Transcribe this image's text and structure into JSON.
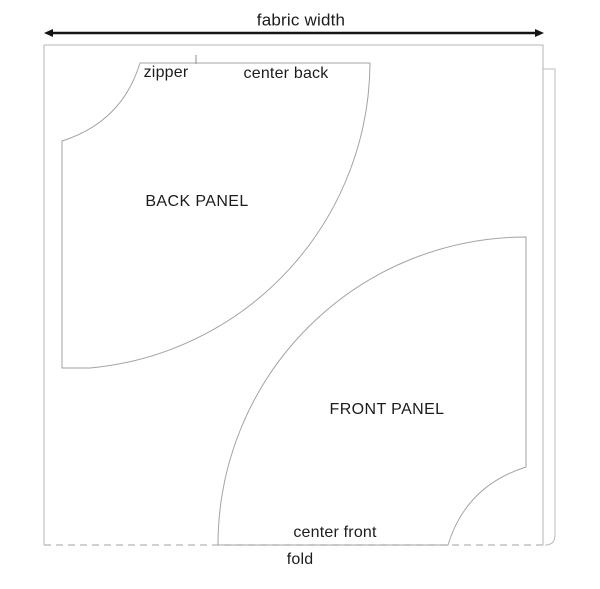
{
  "figure": {
    "type": "sewing-pattern-cutting-layout",
    "labels": {
      "fabric_width": "fabric width",
      "zipper": "zipper",
      "center_back": "center back",
      "back_panel": "BACK PANEL",
      "front_panel": "FRONT PANEL",
      "center_front": "center front",
      "fold": "fold"
    },
    "colors": {
      "background": "#ffffff",
      "pattern_outline": "#a3a3a3",
      "fabric_edge": "#b5b5b5",
      "fold_dash": "#b5b5b5",
      "arrow": "#141414",
      "text": "#1c1c1c"
    },
    "geometry": {
      "fabric_rect": {
        "x": 44,
        "y": 45,
        "width": 499,
        "height": 500
      },
      "waist_radius_px": 78,
      "hem_radius_px": 308,
      "back_panel_origin": {
        "x": 62,
        "y": 63
      },
      "front_panel_origin": {
        "x": 526,
        "y": 545
      },
      "zipper_tick_x": 196
    },
    "paths": {
      "fabric_outline": "M44,545 L44,45 L543,45 L543,545",
      "under_layer": "M543,69 L555,69 L555,535 Q555,545 545,545",
      "fold_line": "M44,545 L545,545",
      "back_panel": "M140,63 L370,63 A308,308 0 0 1 90,368 L62,368 L62,141 Q122,122 140,63 Z",
      "front_panel": "M526,237 L526,467 Q466,486 448,545 L218,545 A308,308 0 0 1 526,237 Z",
      "zipper_tick": "M196,55 L196,64",
      "arrow_line": "M48,33 L540,33",
      "arrow_head_left": "44,33 53,29 53,37",
      "arrow_head_right": "544,33 535,29 535,37"
    }
  }
}
